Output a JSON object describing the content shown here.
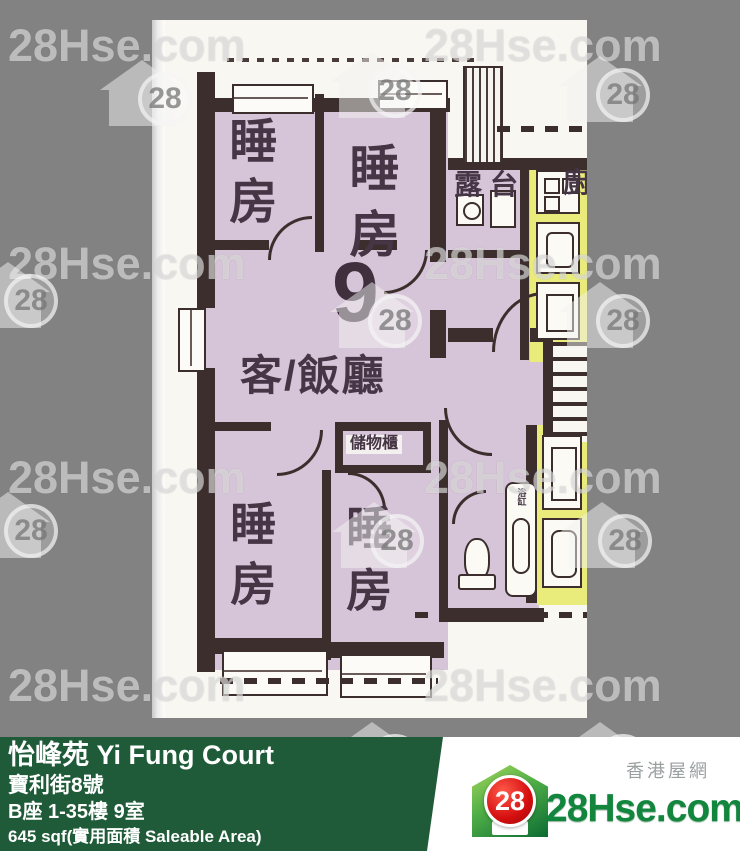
{
  "watermark": {
    "text": "28Hse.com",
    "number": "28"
  },
  "floorplan": {
    "unit_number": "9",
    "labels": {
      "bedroom": "睡房",
      "living_dining": "客/飯廳",
      "balcony": "露台",
      "kitchen": "廚",
      "storage": "儲物櫃",
      "bathtub": "浴缸"
    }
  },
  "footer": {
    "estate_name": "怡峰苑 Yi Fung Court",
    "address": "寶利街8號",
    "block_floor_unit": "B座 1-35樓 9室",
    "area": "645 sqf(實用面積 Saleable Area)"
  },
  "brand": {
    "site_name": "28Hse.com",
    "tagline_cn": "香港屋網",
    "logo_number": "28"
  },
  "colors": {
    "background": "#828282",
    "wall": "#3b2e2d",
    "room_fill": "#d6c4d8",
    "kitchen_fill": "#e9eb7a",
    "footer_green": "#1f5b38",
    "logo_green": "#13863e",
    "logo_red": "#d50f0f"
  }
}
